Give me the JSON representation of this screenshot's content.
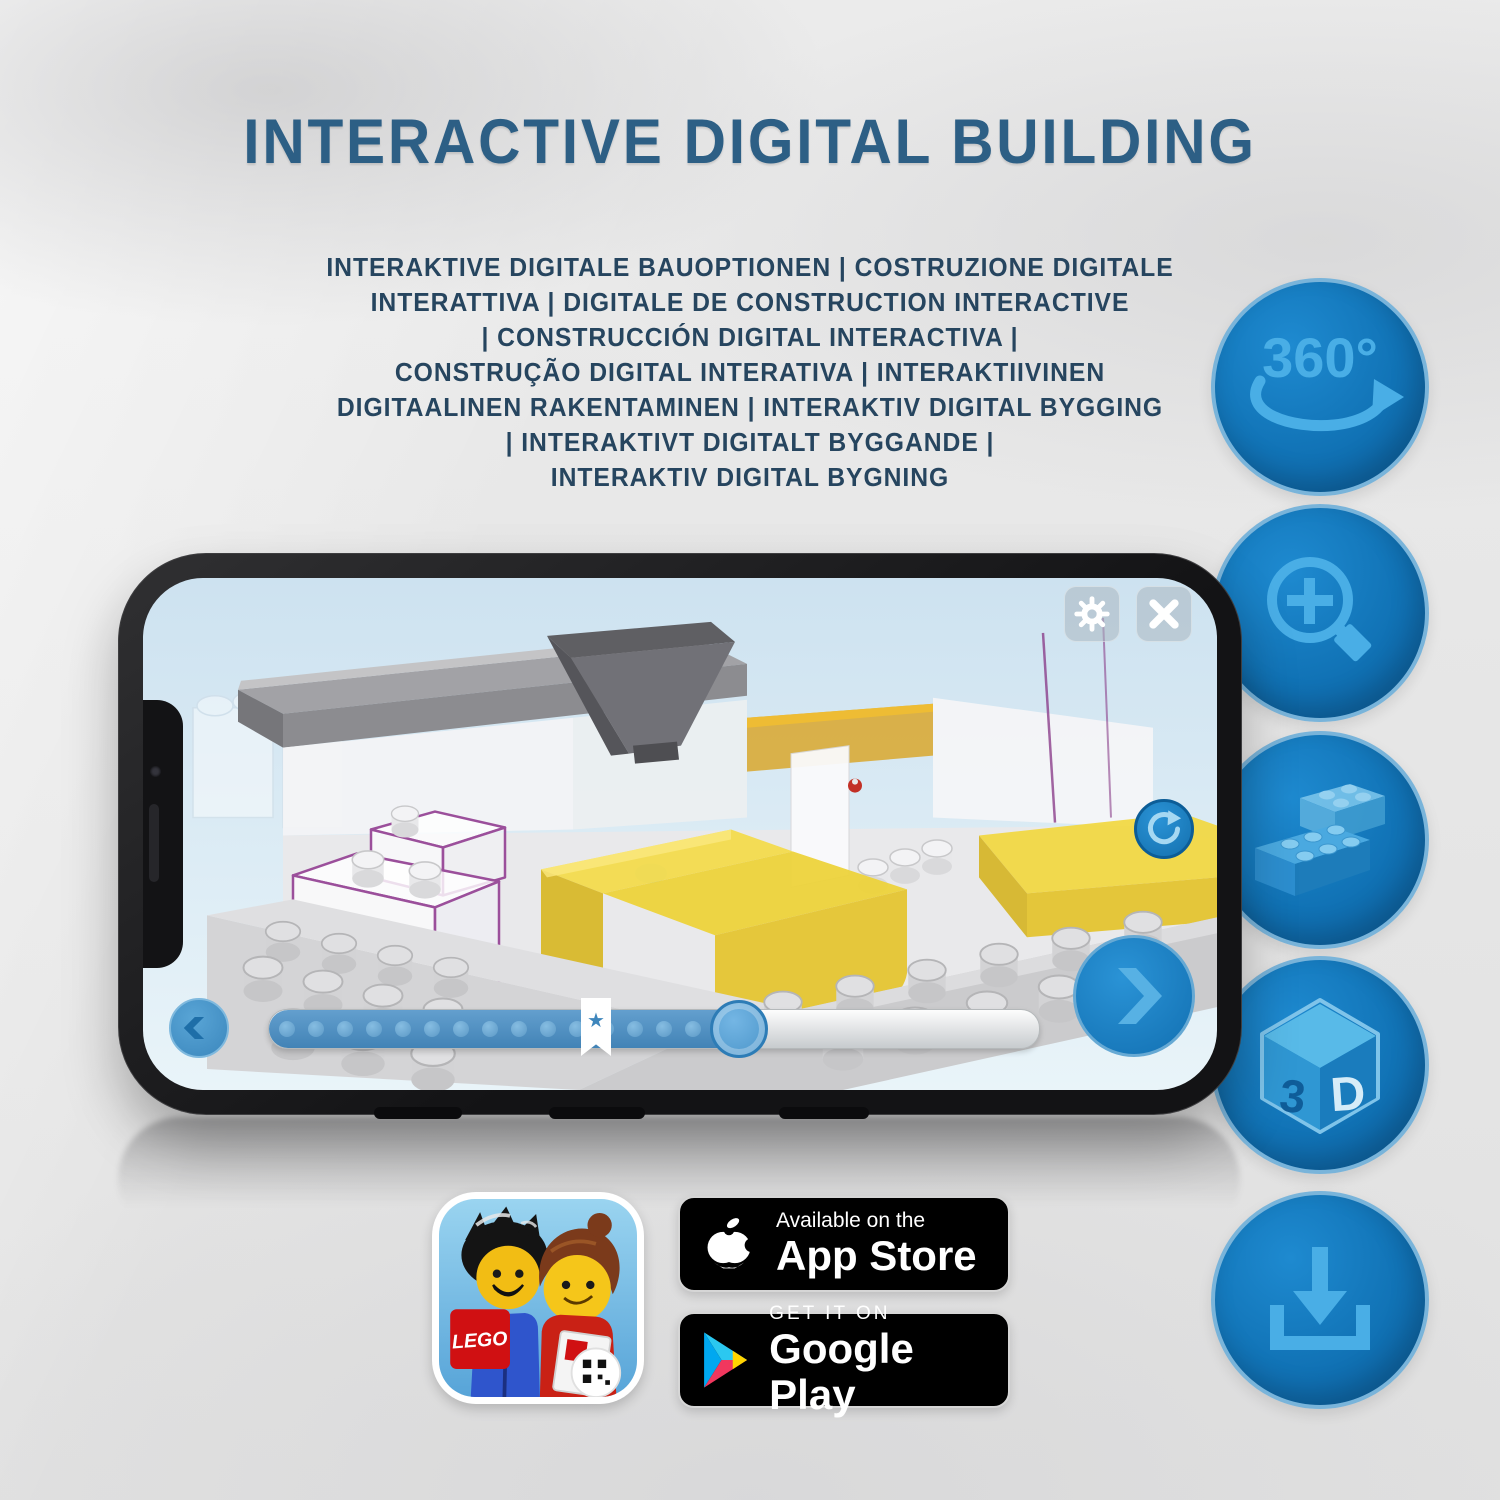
{
  "header": {
    "title": "INTERACTIVE DIGITAL BUILDING",
    "subtitle_lines": [
      "INTERAKTIVE DIGITALE BAUOPTIONEN | COSTRUZIONE DIGITALE",
      "INTERATTIVA | DIGITALE DE CONSTRUCTION INTERACTIVE",
      "| CONSTRUCCIÓN DIGITAL INTERACTIVA |",
      "CONSTRUÇÃO DIGITAL INTERATIVA | INTERAKTIIVINEN",
      "DIGITAALINEN RAKENTAMINEN | INTERAKTIV DIGITAL BYGGING",
      "| INTERAKTIVT DIGITALT BYGGANDE |",
      "INTERAKTIV DIGITAL BYGNING"
    ]
  },
  "features": [
    {
      "name": "360-rotation",
      "label": "360°"
    },
    {
      "name": "zoom-in"
    },
    {
      "name": "interlocking-bricks"
    },
    {
      "name": "3d-view",
      "label_left": "3",
      "label_right": "D"
    },
    {
      "name": "download"
    }
  ],
  "store": {
    "app_store": {
      "line1": "Available on the",
      "line2": "App Store"
    },
    "google_play": {
      "line1": "GET IT ON",
      "line2": "Google Play"
    }
  },
  "app_icon": {
    "lego_logo": "LEGO"
  },
  "colors": {
    "title_blue": "#2d5f85",
    "subtitle_navy": "#26455f",
    "feature_circle_blue": "#1173b6",
    "feature_glyph_blue": "#49aee6",
    "bed_yellow": "#eed338",
    "brick_outline_purple": "#9b4f9b",
    "screen_sky_blue": "#cde2f0"
  }
}
